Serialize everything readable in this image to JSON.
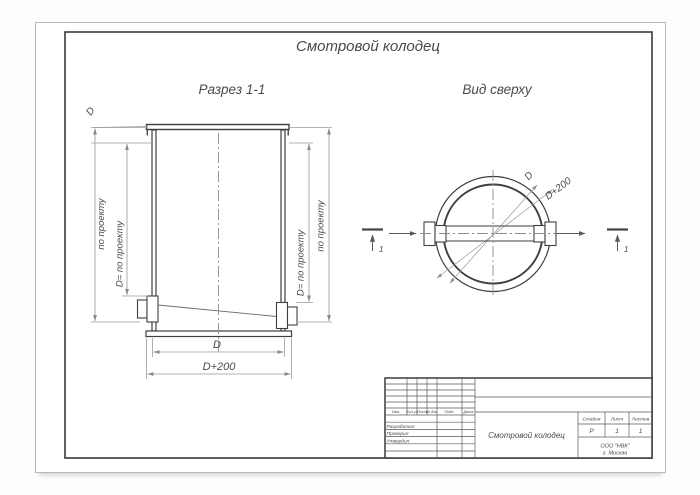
{
  "page": {
    "main_title": "Смотровой колодец"
  },
  "views": {
    "section_title": "Разрез  1-1",
    "plan_title": "Вид сверху"
  },
  "dims": {
    "lid_diameter": "D",
    "po_proektu": "по проекту",
    "d_po_proektu": "D= по проекту",
    "inner_d": "D",
    "outer_d": "D+200",
    "section_no": "1"
  },
  "titleblock": {
    "header": [
      "Изм.",
      "Кол.уч",
      "Лист",
      "№ док.",
      "Подп.",
      "Дата"
    ],
    "roles": [
      "Разработал",
      "Проверил",
      "Утвердил"
    ],
    "doc_name": "Смотровой колодец",
    "stage_label": "Стадия",
    "sheet_label": "Лист",
    "sheets_label": "Листов",
    "stage": "Р",
    "sheet": "1",
    "sheets": "1",
    "org_line1": "ООО \"НВК\"",
    "org_line2": "г. Москва"
  },
  "colors": {
    "main_line": "#3f3f3f",
    "dim_line": "#9a9a9a",
    "frame": "#3a3a3a",
    "sheet_border": "#b9b9b9"
  }
}
